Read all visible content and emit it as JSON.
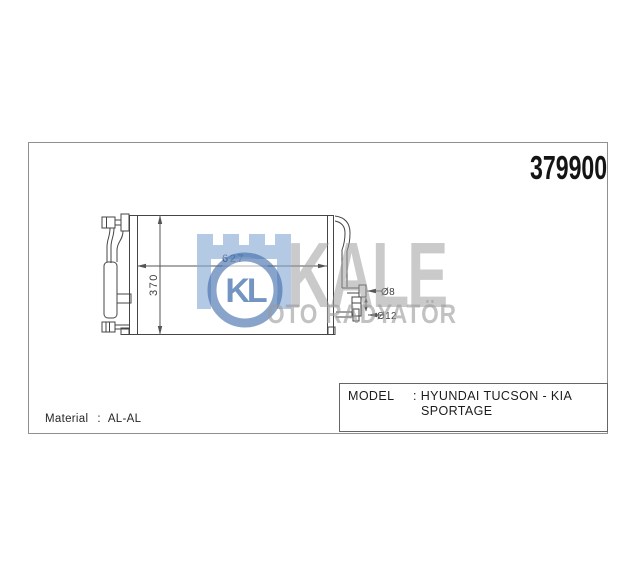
{
  "header": {
    "part_number": "379900"
  },
  "drawing": {
    "width_dim": "627",
    "height_dim": "370",
    "pipe_dim_top": "Ø8",
    "pipe_dim_bottom": "Ø12",
    "line_color": "#454545"
  },
  "watermark": {
    "monogram": "KL",
    "brand": "KALE",
    "subtitle": "OTO RADYATÖR",
    "brand_gray": "#9a9a9a",
    "logo_blue": "#3f6cab",
    "castle_light_blue": "#86a9d4"
  },
  "info": {
    "material_label": "Material",
    "separator": ":",
    "material_value": "AL-AL",
    "model_label": "MODEL",
    "model_value_line1": ": HYUNDAI TUCSON - KIA",
    "model_value_line2": "SPORTAGE"
  }
}
